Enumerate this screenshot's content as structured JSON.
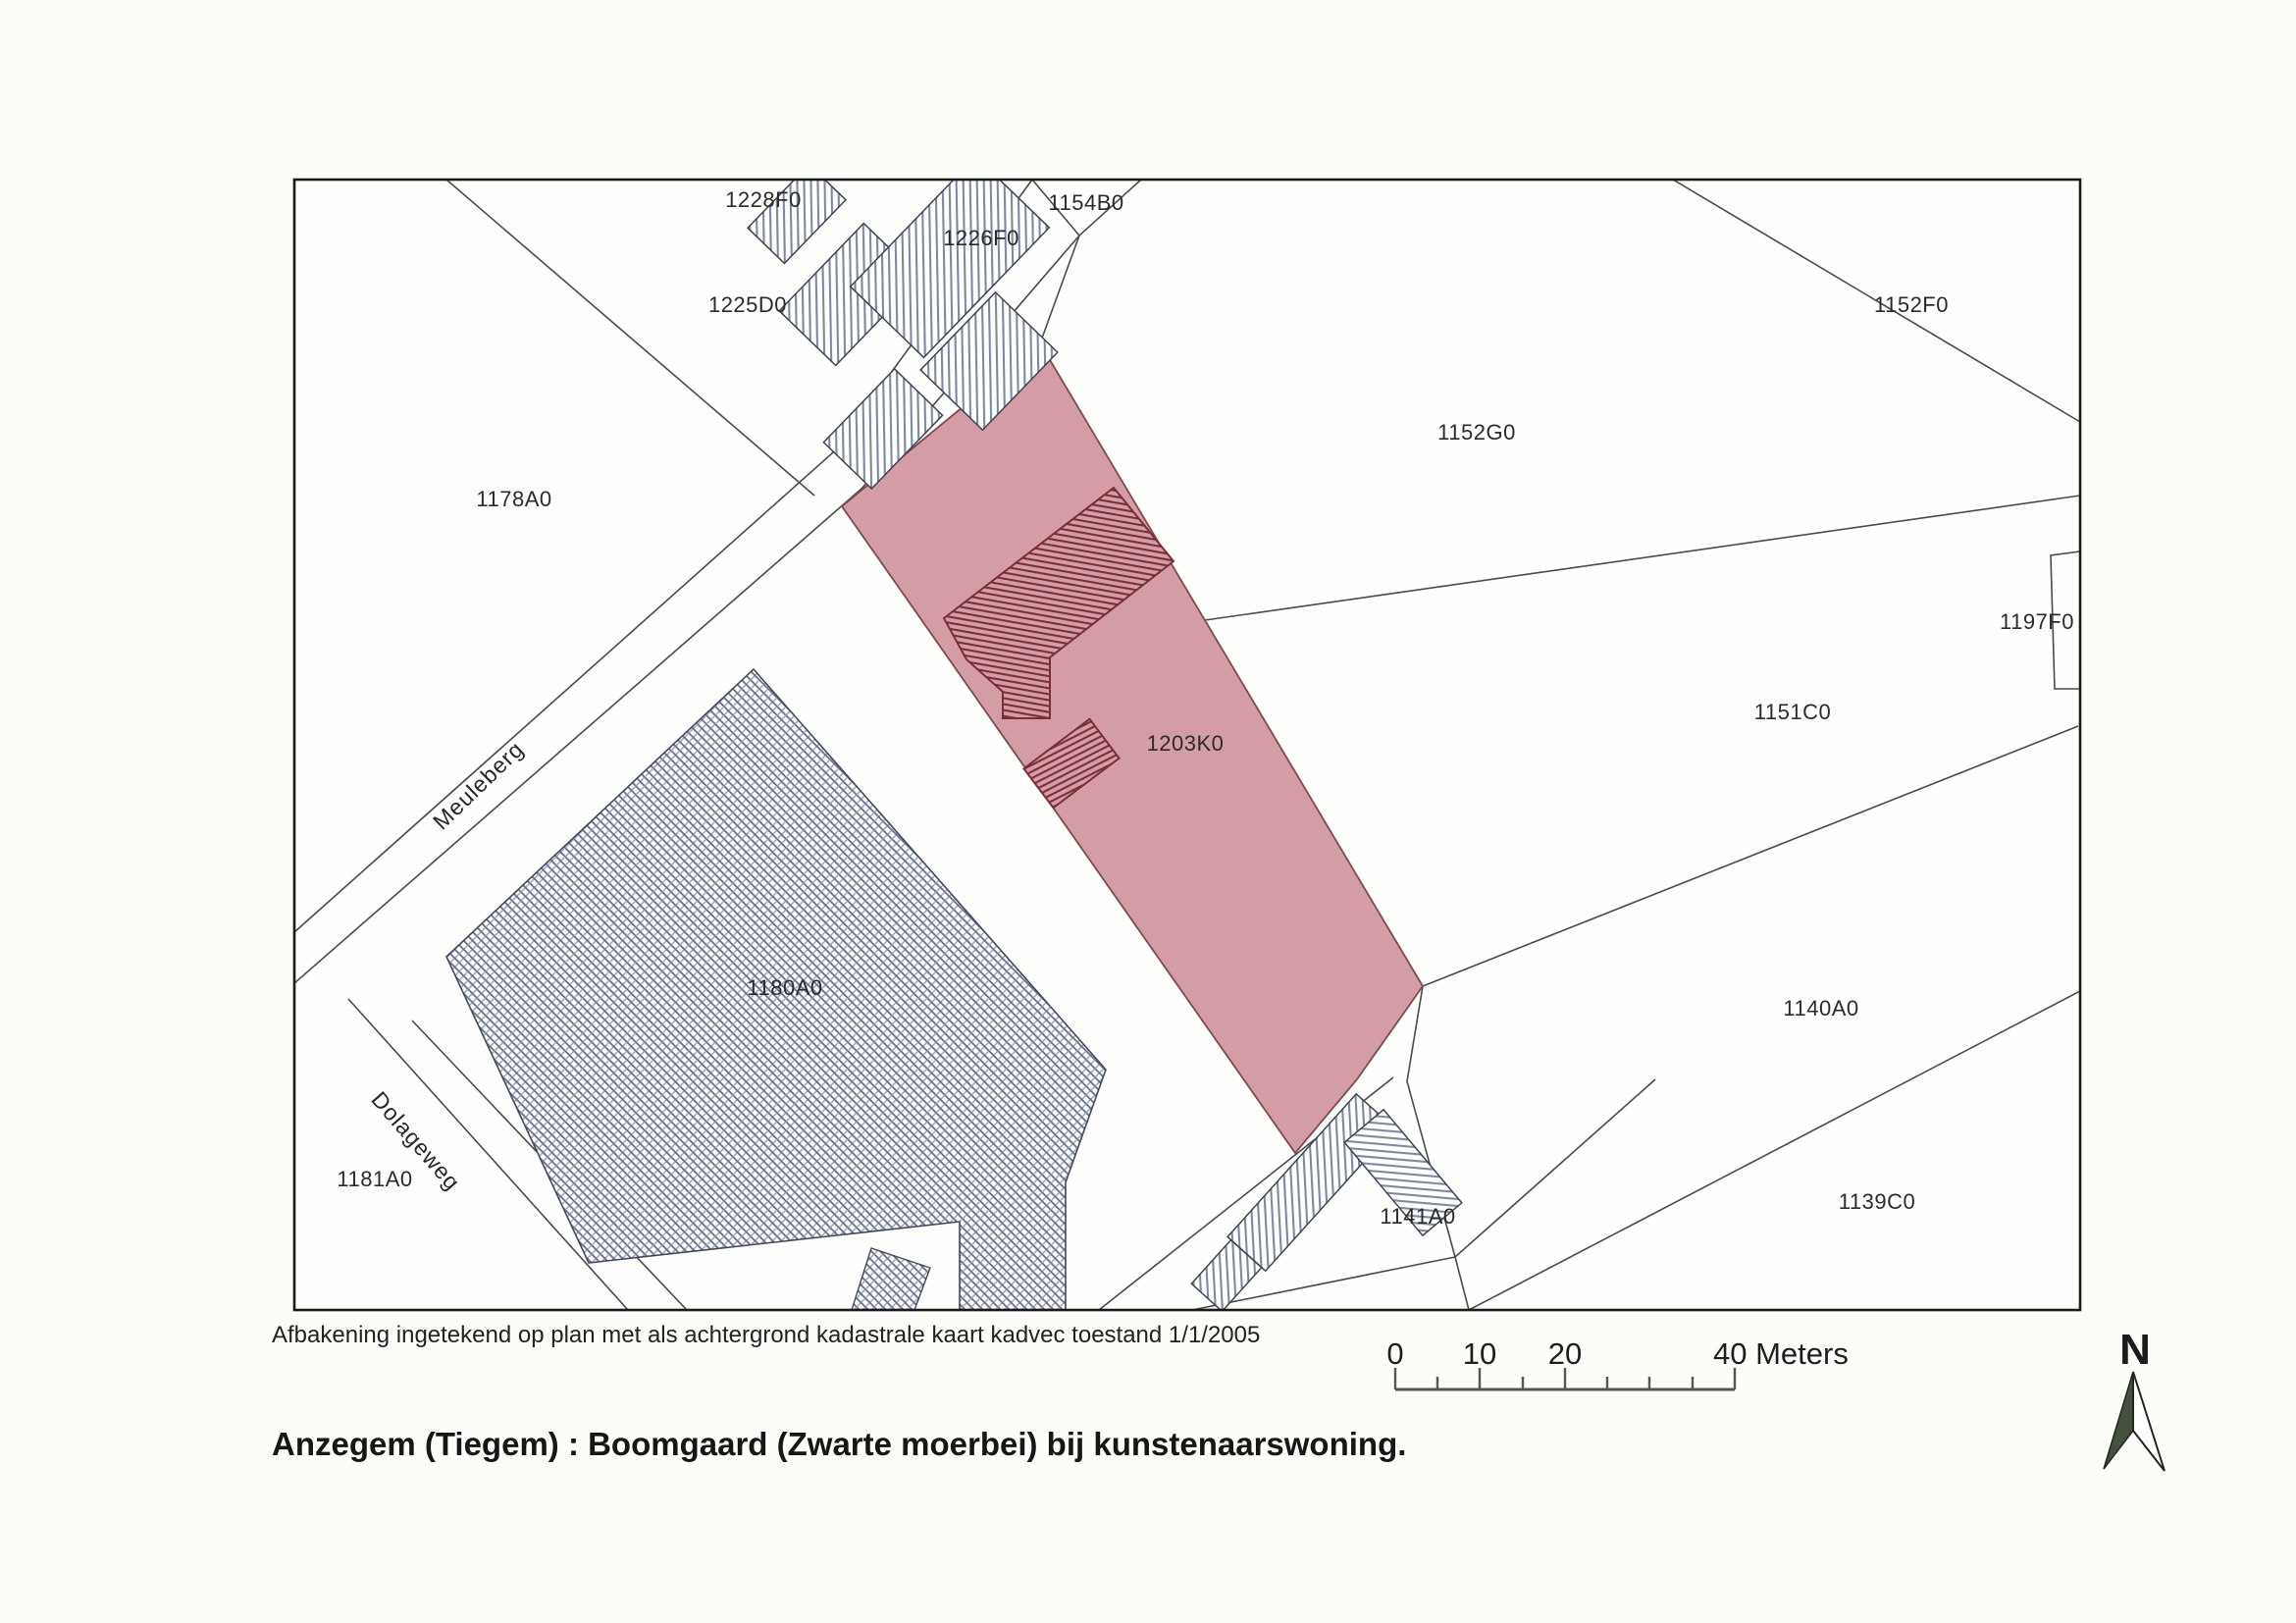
{
  "title": "Anzegem (Tiegem) : Boomgaard (Zwarte moerbei) bij kunstenaarswoning.",
  "caption": "Afbakening ingetekend op plan met als achtergrond kadastrale kaart kadvec toestand 1/1/2005",
  "map": {
    "type": "cadastral-plan-scan",
    "border_color": "#1a1a1a",
    "highlight": {
      "parcel": "1203K0",
      "fill": "#d49da6",
      "hatch_color": "#7b2e3a"
    },
    "hatch_gray_color": "#7e88a0",
    "parcels": [
      {
        "label": "1228F0"
      },
      {
        "label": "1154B0"
      },
      {
        "label": "1226F0"
      },
      {
        "label": "1225D0"
      },
      {
        "label": "1152F0"
      },
      {
        "label": "1152G0"
      },
      {
        "label": "1178A0"
      },
      {
        "label": "1197F0"
      },
      {
        "label": "1151C0"
      },
      {
        "label": "1203K0"
      },
      {
        "label": "1180A0"
      },
      {
        "label": "1140A0"
      },
      {
        "label": "1181A0"
      },
      {
        "label": "1139C0"
      },
      {
        "label": "1141A0"
      }
    ],
    "streets": [
      {
        "name": "Meuleberg"
      },
      {
        "name": "Dolageweg"
      }
    ]
  },
  "scale_bar": {
    "tick_labels": [
      "0",
      "10",
      "20"
    ],
    "end_label": "40 Meters"
  },
  "north_arrow": {
    "label": "N"
  }
}
